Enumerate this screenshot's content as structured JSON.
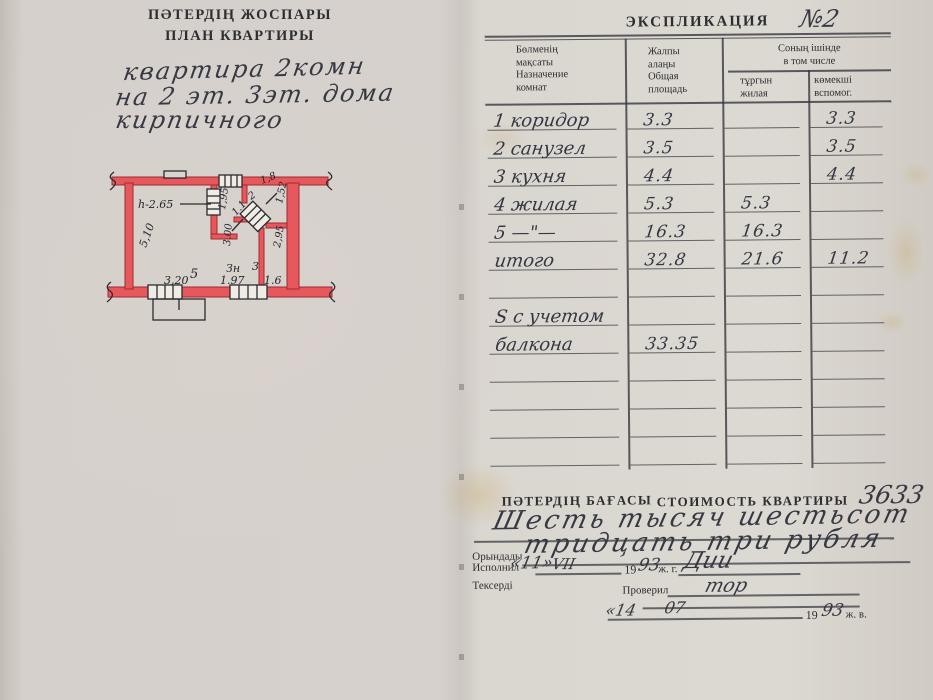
{
  "document": {
    "left_page": {
      "title_kk": "ПӘТЕРДІҢ ЖОСПАРЫ",
      "title_ru": "ПЛАН КВАРТИРЫ",
      "note": {
        "line1": "квартира 2комн",
        "line2": "на 2 эт. 3эт. дома",
        "line3": "кирпичного"
      },
      "floor_plan": {
        "labels": {
          "ceiling_height": "h-2.65",
          "side_510": "5,10",
          "room5": "5",
          "width_320": "3,20",
          "opening_195": "1,95",
          "dim_11": "1.1",
          "dim_18": "1,8",
          "room2": "2",
          "dim_152": "1,52",
          "dim_300": "3.00",
          "dim_295": "2,95",
          "label_zn": "Зн",
          "width_197": "1.97",
          "room3": "3",
          "width_16": "1.6"
        }
      }
    },
    "right_page": {
      "explication": {
        "title": "ЭКСПЛИКАЦИЯ",
        "number": "№2",
        "header": {
          "purpose": [
            "Бөлменің",
            "мақсаты",
            "Назначение",
            "комнат"
          ],
          "total": [
            "Жалпы",
            "алаңы",
            "Общая",
            "площадь"
          ],
          "including": [
            "Соның ішінде",
            "в том числе"
          ],
          "living": [
            "тұргын",
            "жилая"
          ],
          "aux": [
            "көмекші",
            "вспомог."
          ]
        },
        "rows": [
          {
            "name": "1 коридор",
            "total": "3.3",
            "living": "",
            "aux": "3.3"
          },
          {
            "name": "2 санузел",
            "total": "3.5",
            "living": "",
            "aux": "3.5"
          },
          {
            "name": "3 кухня",
            "total": "4.4",
            "living": "",
            "aux": "4.4"
          },
          {
            "name": "4 жилая",
            "total": "5.3",
            "living": "5.3",
            "aux": ""
          },
          {
            "name": "5 —\"—",
            "total": "16.3",
            "living": "16.3",
            "aux": ""
          },
          {
            "name": "итого",
            "total": "32.8",
            "living": "21.6",
            "aux": "11.2"
          },
          {
            "name": "",
            "total": "",
            "living": "",
            "aux": ""
          },
          {
            "name": "S с учетом",
            "total": "",
            "living": "",
            "aux": ""
          },
          {
            "name": "балкона",
            "total": "33.35",
            "living": "",
            "aux": ""
          },
          {
            "name": "",
            "total": "",
            "living": "",
            "aux": ""
          },
          {
            "name": "",
            "total": "",
            "living": "",
            "aux": ""
          },
          {
            "name": "",
            "total": "",
            "living": "",
            "aux": ""
          },
          {
            "name": "",
            "total": "",
            "living": "",
            "aux": ""
          }
        ]
      },
      "valuation": {
        "label_kk": "ПӘТЕРДІҢ БАҒАСЫ",
        "label_ru": "СТОИМОСТЬ КВАРТИРЫ",
        "amount": "3633",
        "words1": "Шесть тысяч шестьсот",
        "words2": "тридцать три рубля"
      },
      "sign": {
        "executed_kk": "Орындады",
        "executed_ru": "Исполнил",
        "executed_day": "«11»",
        "executed_month": "VII",
        "year19": "19",
        "executed_year": "93",
        "suffix_g": "ж. г.",
        "executed_sign": "Дии",
        "checked_kk": "Тексерді",
        "checked_ru": "Проверил",
        "checked_sign": "тор",
        "checked_day": "«14",
        "checked_month": "07",
        "checked_year": "93",
        "suffix_v": "ж. в."
      }
    }
  }
}
